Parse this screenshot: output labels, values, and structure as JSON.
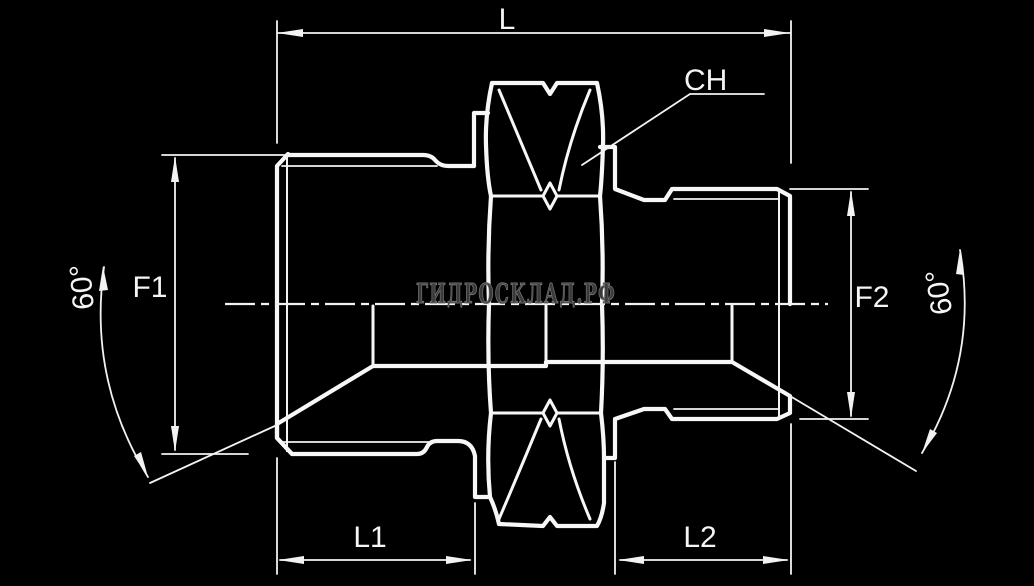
{
  "drawing": {
    "type": "technical-section-drawing",
    "subject": "straight-male-adapter-fitting",
    "watermark": "ГИДРОСКЛАД.РФ",
    "labels": {
      "total_length": "L",
      "wrench_size": "CH",
      "thread1_diameter": "F1",
      "thread2_diameter": "F2",
      "thread1_length": "L1",
      "thread2_length": "L2",
      "cone_angle_left": "60°",
      "cone_angle_right": "60°"
    },
    "colors": {
      "background": "#000000",
      "line": "#f7f7f7",
      "watermark_fill": "#3a3a3a",
      "watermark_stroke": "#6f6f6f"
    }
  }
}
